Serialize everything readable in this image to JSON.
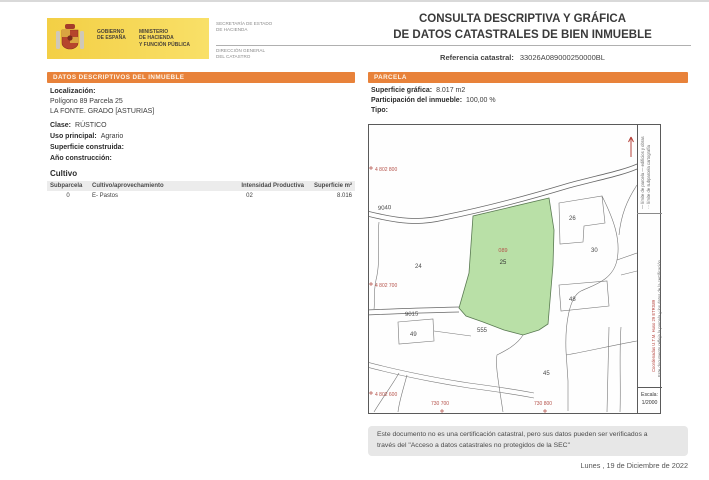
{
  "header": {
    "logo": {
      "gobierno": "GOBIERNO\nDE ESPAÑA",
      "ministerio": "MINISTERIO\nDE HACIENDA\nY FUNCIÓN PÚBLICA",
      "secretaria": "SECRETARÍA DE ESTADO\nDE HACIENDA",
      "direccion": "DIRECCIÓN GENERAL\nDEL CATASTRO"
    },
    "title": "CONSULTA DESCRIPTIVA Y GRÁFICA\nDE DATOS CATASTRALES DE BIEN INMUEBLE",
    "ref_label": "Referencia catastral:",
    "ref_value": "33026A089000250000BL"
  },
  "left_panel": {
    "header": "DATOS DESCRIPTIVOS DEL INMUEBLE",
    "localizacion_label": "Localización:",
    "localizacion_line1": "Polígono 89 Parcela 25",
    "localizacion_line2": "LA FONTE. GRADO [ASTURIAS]",
    "fields": [
      {
        "label": "Clase:",
        "value": "RÚSTICO"
      },
      {
        "label": "Uso principal:",
        "value": "Agrario"
      },
      {
        "label": "Superficie construida:",
        "value": ""
      },
      {
        "label": "Año construcción:",
        "value": ""
      }
    ],
    "cultivo": {
      "title": "Cultivo",
      "columns": [
        "Subparcela",
        "Cultivo/aprovechamiento",
        "Intensidad Productiva",
        "Superficie m²"
      ],
      "rows": [
        [
          "0",
          "E- Pastos",
          "02",
          "8.016"
        ]
      ]
    }
  },
  "right_panel": {
    "header": "PARCELA",
    "fields": [
      {
        "label": "Superficie gráfica:",
        "value": "8.017 m2"
      },
      {
        "label": "Participación del inmueble:",
        "value": "100,00 %"
      },
      {
        "label": "Tipo:",
        "value": ""
      }
    ],
    "map": {
      "subject_parcel": {
        "code": "089",
        "number": "25"
      },
      "road_labels": [
        "9040",
        "9015"
      ],
      "neighbor_parcels": [
        "24",
        "26",
        "30",
        "48",
        "555",
        "49",
        "45"
      ],
      "coord_labels_left": [
        "4 802 800",
        "4 802 700",
        "4 802 600"
      ],
      "coord_labels_bottom": [
        "730 700",
        "730 800"
      ],
      "legend_col1": "— límite de parcela    — edificios y obras",
      "legend_col2": "··· límite de subparcela    cartografía",
      "utm_note": "Coordenadas U.T.M. Huso 29 ETRS89",
      "cert_note": "Este documento refleja la parcela y los datos de la certificación",
      "scale": "Escala:\n1/2000"
    }
  },
  "footer": {
    "disclaimer": "Este documento no es una certificación catastral, pero sus datos pueden ser verificados a\ntravés del \"Acceso a datos catastrales no protegidos de la SEC\"",
    "date": "Lunes , 19 de Diciembre de 2022"
  },
  "colors": {
    "accent_orange": "#e8823a",
    "logo_yellow": "#f6d54a",
    "parcel_green": "#b9e0a7",
    "coord_red": "#b5524a"
  }
}
